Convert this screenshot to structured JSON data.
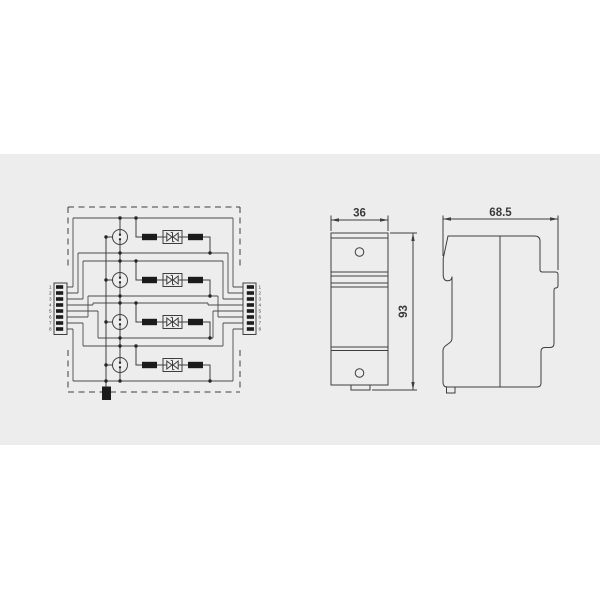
{
  "page": {
    "background": "#ffffff",
    "panel_background": "#EDEDED",
    "line_color": "#3E3E3E"
  },
  "circuit": {
    "description": "4-pair surge protection circuit",
    "left_connector": {
      "pins": [
        "1",
        "2",
        "3",
        "4",
        "5",
        "6",
        "7",
        "8"
      ]
    },
    "right_connector": {
      "pins": [
        "1",
        "2",
        "3",
        "4",
        "5",
        "6",
        "7",
        "8"
      ]
    },
    "channels": 4,
    "channel_components": [
      "gas-discharge-tube",
      "resistor",
      "bidirectional-tvs-diode",
      "resistor"
    ]
  },
  "front_view": {
    "width_label": "36",
    "height_label": "93"
  },
  "side_view": {
    "depth_label": "68.5"
  }
}
